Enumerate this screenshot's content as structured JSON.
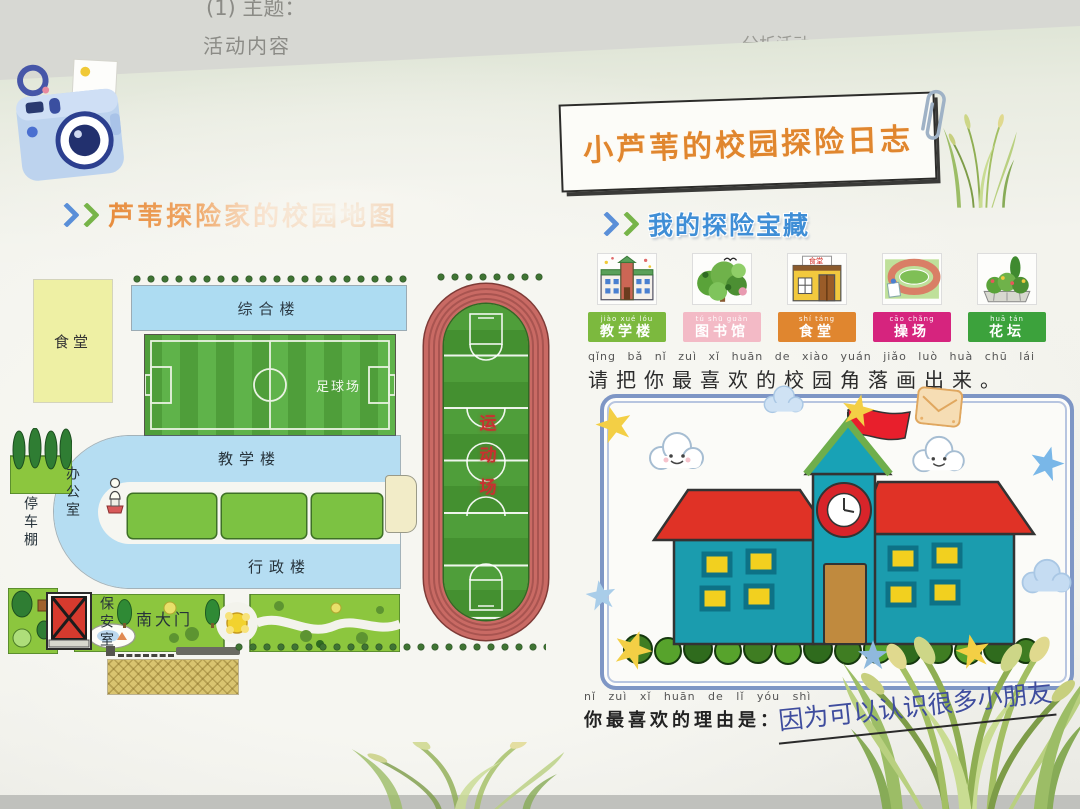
{
  "photo": {
    "background_text_1": "(1) 主题：",
    "background_text_2": "活动内容",
    "background_text_3": "分析活动"
  },
  "left_section": {
    "heading": "芦苇探险家的校园地图",
    "map": {
      "canteen": "食堂",
      "complex_building": "综合楼",
      "football_field": "足球场",
      "teaching_building": "教学楼",
      "office": "办公室",
      "admin_building": "行政楼",
      "parking_shed": "停车棚",
      "security_room": "保安室",
      "south_gate": "南大门",
      "sports_ground": "运动场"
    }
  },
  "right_section": {
    "journal_title": "小芦苇的校园探险日志",
    "heading": "我的探险宝藏",
    "treasures": [
      {
        "label": "教学楼",
        "pinyin": "jiào xué lóu",
        "color": "#7cb93e"
      },
      {
        "label": "图书馆",
        "pinyin": "tú shū guǎn",
        "color": "#f3bac6"
      },
      {
        "label": "食堂",
        "pinyin": "shí táng",
        "color": "#e0862f"
      },
      {
        "label": "操场",
        "pinyin": "cāo chǎng",
        "color": "#d6247e"
      },
      {
        "label": "花坛",
        "pinyin": "huā tán",
        "color": "#3ca23c"
      }
    ],
    "draw_prompt": {
      "pinyin": "qǐng bǎ nǐ zuì xǐ huān de xiào yuán jiǎo luò huà chū lái",
      "text": "请把你最喜欢的校园角落画出来。"
    },
    "reason": {
      "pinyin": "nǐ zuì xǐ huān de lǐ yóu shì",
      "label": "你最喜欢的理由是：",
      "answer": "因为可以认识很多小朋友"
    }
  }
}
